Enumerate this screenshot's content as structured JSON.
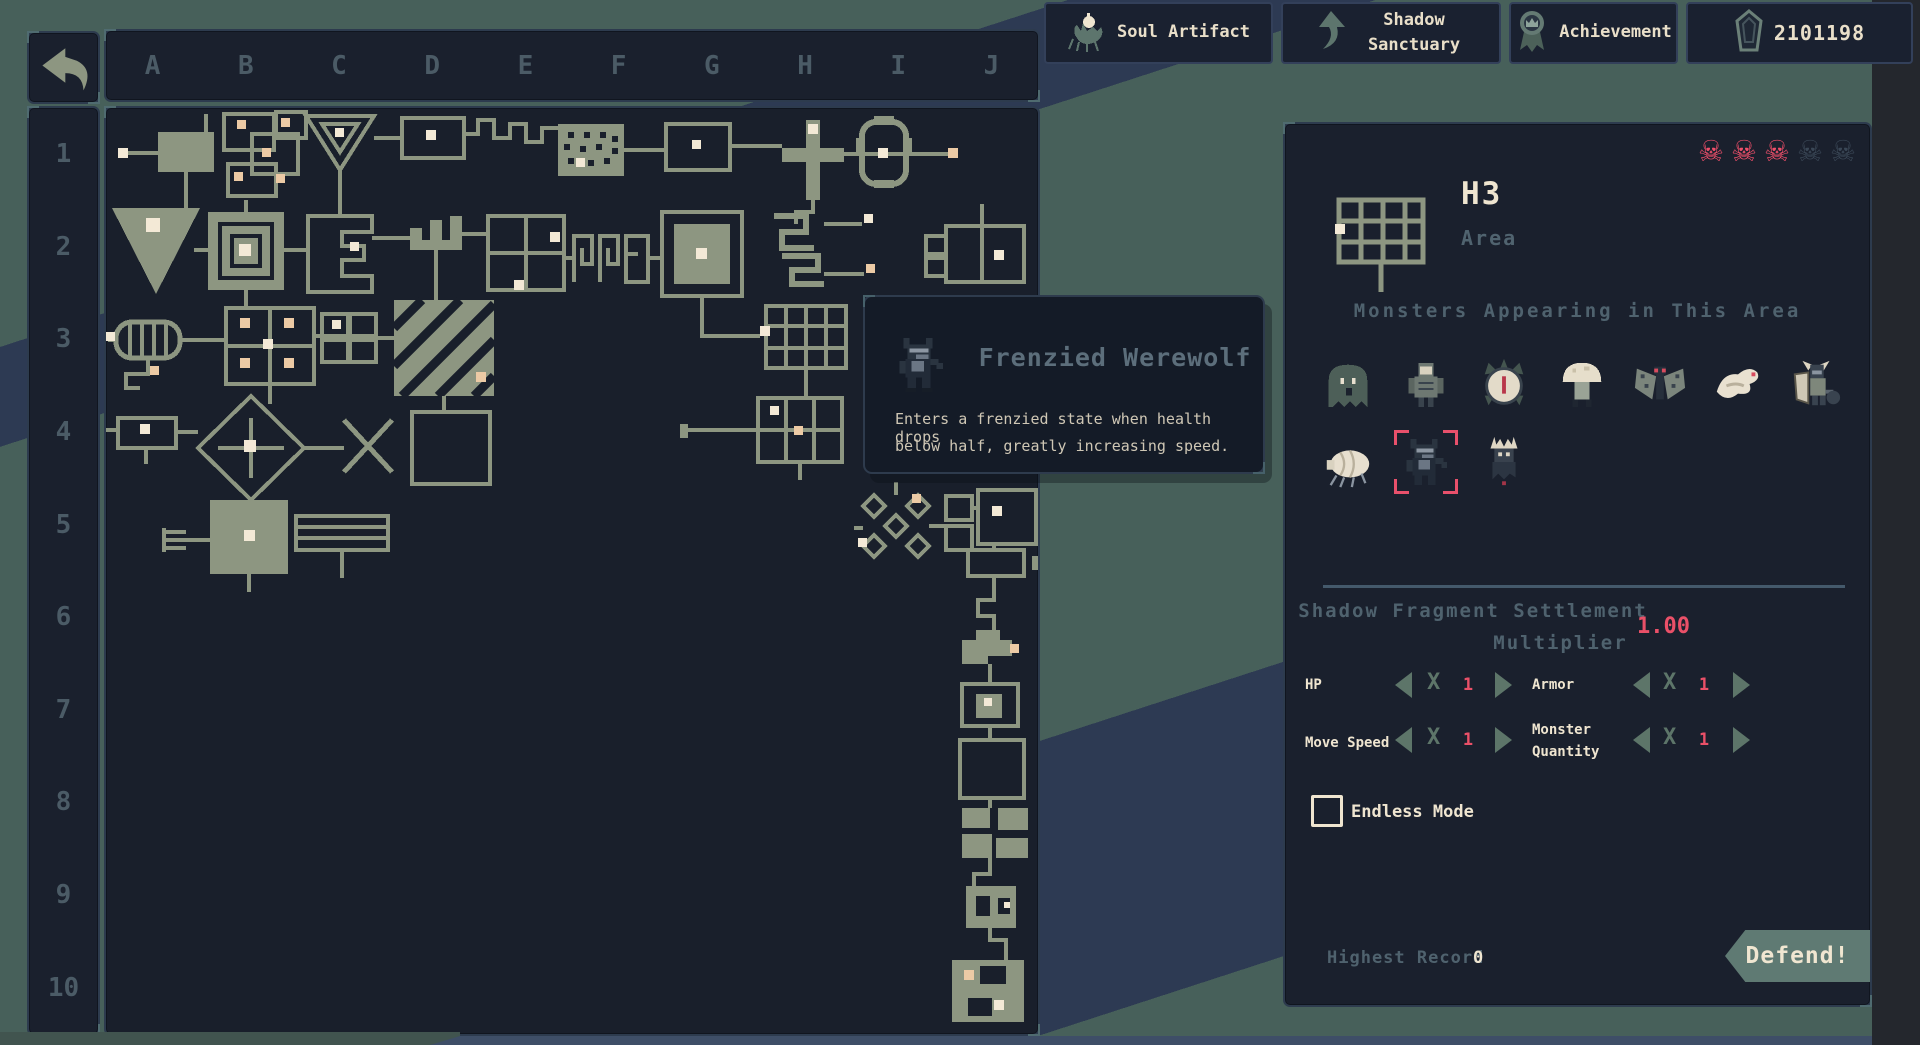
{
  "top_bar": {
    "soul_artifact": {
      "label": "Soul Artifact"
    },
    "shadow_sanctuary": {
      "label": "Shadow Sanctuary"
    },
    "achievement": {
      "label": "Achievement"
    },
    "currency": {
      "value": "2101198"
    }
  },
  "map_browser": {
    "column_labels": [
      "A",
      "B",
      "C",
      "D",
      "E",
      "F",
      "G",
      "H",
      "I",
      "J"
    ],
    "row_labels": [
      "1",
      "2",
      "3",
      "4",
      "5",
      "6",
      "7",
      "8",
      "9",
      "10"
    ]
  },
  "tooltip": {
    "monster_name": "Frenzied Werewolf",
    "description_line1": "Enters a frenzied state when health drops",
    "description_line2": "below half, greatly increasing speed."
  },
  "area_panel": {
    "title": "H3",
    "subtitle": "Area",
    "skull_glyph": "☠",
    "danger_skulls_active": 3,
    "danger_skulls_total": 5,
    "monsters_header": "Monsters Appearing in This Area",
    "monster_icons": [
      "shade-monster-icon",
      "brute-monster-icon",
      "spike-orb-monster-icon",
      "mushroom-monster-icon",
      "moth-monster-icon",
      "bone-bird-monster-icon",
      "horned-knight-monster-icon",
      "louse-monster-icon",
      "frenzied-werewolf-icon",
      "crowned-wraith-monster-icon"
    ],
    "selected_monster_index": 8,
    "settlement_title_line1": "Shadow Fragment Settlement",
    "settlement_title_line2": "Multiplier",
    "settlement_value": "1.00",
    "multiply_sign": "X",
    "stats": [
      {
        "label": "HP",
        "value": "1"
      },
      {
        "label": "Armor",
        "value": "1"
      },
      {
        "label": "Move Speed",
        "value": "1"
      },
      {
        "label": "Monster Quantity",
        "value": "1"
      }
    ],
    "endless_mode_label": "Endless Mode",
    "endless_checked": false,
    "highest_record_label": "Highest Record",
    "highest_record_value": "0",
    "defend_label": "Defend!"
  },
  "colors": {
    "accent_red": "#ea5068",
    "map_sage": "#8d9681",
    "background_teal": "#47605a",
    "background_navy": "#2d3a53"
  }
}
